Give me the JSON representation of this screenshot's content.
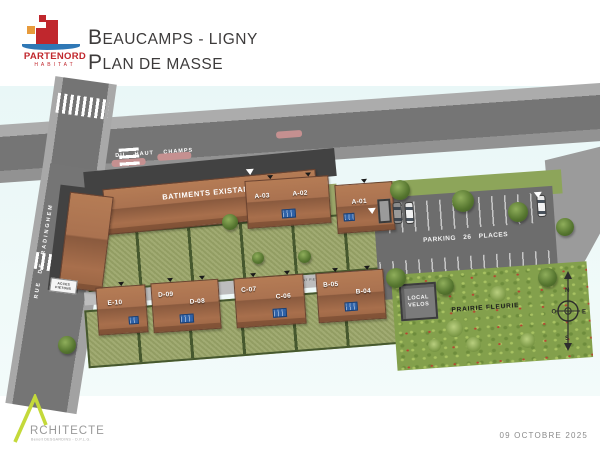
{
  "header": {
    "logo": {
      "brand": "PARTENORD",
      "sub": "HABITAT"
    },
    "title_line1_initial": "B",
    "title_line1_rest": "EAUCAMPS - LIGNY",
    "title_line2_initial": "P",
    "title_line2_rest": "LAN DE MASSE"
  },
  "plan": {
    "streets": {
      "main": "RUE DU HAUT CHAMPS",
      "left": "RUE DE RADINGHEM"
    },
    "labels": {
      "existing": "BATIMENTS EXISTANTS",
      "parking": "PARKING 26 PLACES",
      "velos_line1": "LOCAL",
      "velos_line2": "VELOS",
      "prairie": "PRAIRIE FLEURIE",
      "acces_line1": "ACCES",
      "acces_line2": "PIETONS",
      "chem": "CHEMINEMENT PIETON"
    },
    "buildings": {
      "a_block": [
        "A-03",
        "A-02"
      ],
      "a01": [
        "A-01"
      ],
      "e_block": [
        "E-10"
      ],
      "d_block": [
        "D-09",
        "D-08"
      ],
      "c_block": [
        "C-07",
        "C-06"
      ],
      "b_block": [
        "B-05",
        "B-04"
      ]
    },
    "compass": {
      "n": "N",
      "s": "S",
      "e": "E",
      "o": "O"
    }
  },
  "footer": {
    "architect_initial": "A",
    "architect_rest": "RCHITECTE",
    "architect_sub": "Benoit DESGARDINS - D.P.L.G.",
    "date": "09 OCTOBRE 2025"
  },
  "colors": {
    "brand_red": "#c0272d",
    "brand_blue": "#2f78b6",
    "brand_orange": "#e79b3c",
    "roof": "#a9714e",
    "solar_panel": "#2f62a8",
    "road": "#767676",
    "parking": "#6d6d6d",
    "garden": "#9aa568",
    "hedge": "#46582e",
    "prairie": "#83a04c",
    "plan_bg": "#e9f7f7",
    "architect_lime": "#c4d93a"
  }
}
